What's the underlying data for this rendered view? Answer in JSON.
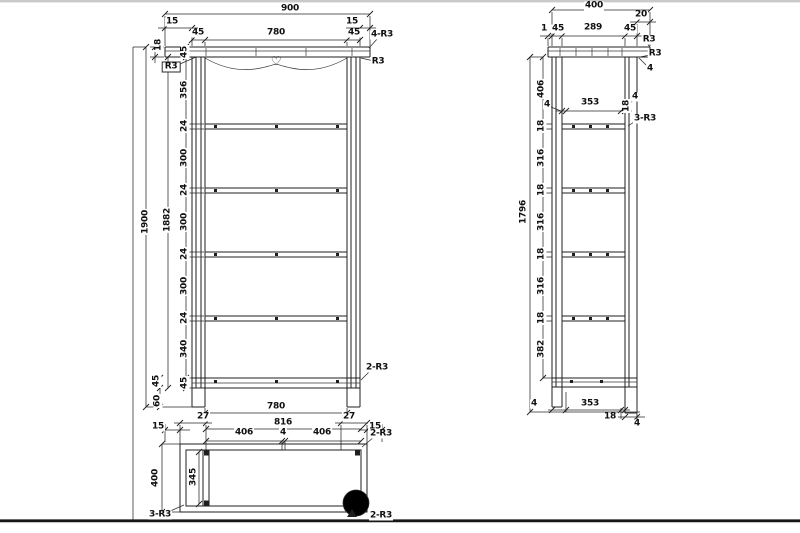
{
  "drawing": {
    "background": "#ffffff",
    "line_color": "#1f1f1f",
    "baseline_color": "#161616",
    "top_edge_color": "#c9c9c9",
    "heart_icon": "♡"
  },
  "views": {
    "front": {
      "labels": [
        {
          "name": "dim-overall-width",
          "text": "900",
          "x": 290,
          "y": 9
        },
        {
          "name": "dim-overhang-left",
          "text": "15",
          "x": 172,
          "y": 22
        },
        {
          "name": "dim-overhang-right",
          "text": "15",
          "x": 352,
          "y": 22
        },
        {
          "name": "dim-inner-width-top",
          "text": "780",
          "x": 276,
          "y": 33
        },
        {
          "name": "dim-post-width-top-left",
          "text": "45",
          "x": 198,
          "y": 33
        },
        {
          "name": "dim-post-width-top-right",
          "text": "45",
          "x": 354,
          "y": 33
        },
        {
          "name": "note-4-r3",
          "text": "4-R3",
          "x": 382,
          "y": 35
        },
        {
          "name": "dim-top-rail-thickness",
          "text": "18",
          "x": 159,
          "y": 45,
          "rot": 1
        },
        {
          "name": "dim-chain-45-top",
          "text": "45",
          "x": 185,
          "y": 52,
          "rot": 1
        },
        {
          "name": "note-r3-left",
          "text": "R3",
          "x": 171,
          "y": 67,
          "cls": "boxed"
        },
        {
          "name": "note-r3-right",
          "text": "R3",
          "x": 378,
          "y": 62
        },
        {
          "name": "dim-chain-356",
          "text": "356",
          "x": 185,
          "y": 90,
          "rot": 1
        },
        {
          "name": "dim-chain-24-1",
          "text": "24",
          "x": 185,
          "y": 126,
          "rot": 1
        },
        {
          "name": "dim-chain-300-1",
          "text": "300",
          "x": 185,
          "y": 158,
          "rot": 1
        },
        {
          "name": "dim-chain-24-2",
          "text": "24",
          "x": 185,
          "y": 190,
          "rot": 1
        },
        {
          "name": "dim-chain-300-2",
          "text": "300",
          "x": 185,
          "y": 222,
          "rot": 1
        },
        {
          "name": "dim-chain-24-3",
          "text": "24",
          "x": 185,
          "y": 254,
          "rot": 1
        },
        {
          "name": "dim-chain-300-3",
          "text": "300",
          "x": 185,
          "y": 286,
          "rot": 1
        },
        {
          "name": "dim-chain-24-4",
          "text": "24",
          "x": 185,
          "y": 318,
          "rot": 1
        },
        {
          "name": "dim-chain-340",
          "text": "340",
          "x": 185,
          "y": 349,
          "rot": 1
        },
        {
          "name": "dim-chain-45-bottom",
          "text": "45",
          "x": 185,
          "y": 383,
          "rot": 1
        },
        {
          "name": "dim-overall-height",
          "text": "1900",
          "x": 146,
          "y": 222,
          "rot": 1
        },
        {
          "name": "dim-inner-height",
          "text": "1882",
          "x": 168,
          "y": 220,
          "rot": 1
        },
        {
          "name": "dim-bottom-rail-45",
          "text": "45",
          "x": 157,
          "y": 381,
          "rot": 1
        },
        {
          "name": "dim-leg-height-60",
          "text": "60",
          "x": 158,
          "y": 401,
          "rot": 1
        },
        {
          "name": "dim-inner-width-bottom",
          "text": "780",
          "x": 276,
          "y": 407
        },
        {
          "name": "note-2-r3-front",
          "text": "2-R3",
          "x": 377,
          "y": 368
        },
        {
          "name": "heart-icon",
          "text": "♡",
          "x": 276,
          "y": 61,
          "cls": "heart"
        }
      ]
    },
    "plan": {
      "labels": [
        {
          "name": "dim-plan-15-left",
          "text": "15",
          "x": 158,
          "y": 427
        },
        {
          "name": "dim-plan-27-left",
          "text": "27",
          "x": 203,
          "y": 417
        },
        {
          "name": "dim-plan-27-right",
          "text": "27",
          "x": 349,
          "y": 417
        },
        {
          "name": "dim-plan-816",
          "text": "816",
          "x": 283,
          "y": 423
        },
        {
          "name": "dim-plan-4",
          "text": "4",
          "x": 283,
          "y": 433
        },
        {
          "name": "dim-plan-406-left",
          "text": "406",
          "x": 244,
          "y": 433
        },
        {
          "name": "dim-plan-406-right",
          "text": "406",
          "x": 322,
          "y": 433
        },
        {
          "name": "dim-plan-15-right",
          "text": "15",
          "x": 375,
          "y": 427
        },
        {
          "name": "note-2-r3-plan-top",
          "text": "2-R3",
          "x": 381,
          "y": 434
        },
        {
          "name": "dim-plan-400",
          "text": "400",
          "x": 156,
          "y": 478,
          "rot": 1
        },
        {
          "name": "dim-plan-345",
          "text": "345",
          "x": 194,
          "y": 477,
          "rot": 1
        },
        {
          "name": "note-3-r3-plan",
          "text": "3-R3",
          "x": 160,
          "y": 515
        },
        {
          "name": "note-2-r3-plan-bottom",
          "text": "2-R3",
          "x": 381,
          "y": 516
        }
      ]
    },
    "side": {
      "labels": [
        {
          "name": "dim-side-width",
          "text": "400",
          "x": 594,
          "y": 6
        },
        {
          "name": "dim-side-20",
          "text": "20",
          "x": 641,
          "y": 15
        },
        {
          "name": "dim-side-1",
          "text": "1",
          "x": 544,
          "y": 29
        },
        {
          "name": "dim-side-45-left",
          "text": "45",
          "x": 558,
          "y": 29
        },
        {
          "name": "dim-side-289",
          "text": "289",
          "x": 593,
          "y": 28
        },
        {
          "name": "dim-side-45-right",
          "text": "45",
          "x": 630,
          "y": 29
        },
        {
          "name": "note-r3-side-top",
          "text": "R3",
          "x": 649,
          "y": 40
        },
        {
          "name": "note-r3-side-mid",
          "text": "R3",
          "x": 655,
          "y": 54
        },
        {
          "name": "dim-side-4-top",
          "text": "4",
          "x": 650,
          "y": 69
        },
        {
          "name": "dim-side-406",
          "text": "406",
          "x": 542,
          "y": 89,
          "rot": 1
        },
        {
          "name": "dim-side-4-shelf-left",
          "text": "4",
          "x": 547,
          "y": 105
        },
        {
          "name": "dim-side-353-top",
          "text": "353",
          "x": 590,
          "y": 103
        },
        {
          "name": "dim-side-4-shelf-right",
          "text": "4",
          "x": 635,
          "y": 97
        },
        {
          "name": "dim-side-18-shelf",
          "text": "18",
          "x": 627,
          "y": 106,
          "rot": 1
        },
        {
          "name": "note-3-r3-side",
          "text": "3-R3",
          "x": 645,
          "y": 119
        },
        {
          "name": "dim-side-18-1",
          "text": "18",
          "x": 542,
          "y": 126,
          "rot": 1
        },
        {
          "name": "dim-side-316-1",
          "text": "316",
          "x": 542,
          "y": 158,
          "rot": 1
        },
        {
          "name": "dim-side-18-2",
          "text": "18",
          "x": 542,
          "y": 190,
          "rot": 1
        },
        {
          "name": "dim-side-316-2",
          "text": "316",
          "x": 542,
          "y": 222,
          "rot": 1
        },
        {
          "name": "dim-side-18-3",
          "text": "18",
          "x": 542,
          "y": 254,
          "rot": 1
        },
        {
          "name": "dim-side-316-3",
          "text": "316",
          "x": 542,
          "y": 286,
          "rot": 1
        },
        {
          "name": "dim-side-18-4",
          "text": "18",
          "x": 542,
          "y": 318,
          "rot": 1
        },
        {
          "name": "dim-side-382",
          "text": "382",
          "x": 542,
          "y": 349,
          "rot": 1
        },
        {
          "name": "dim-side-1796",
          "text": "1796",
          "x": 524,
          "y": 212,
          "rot": 1
        },
        {
          "name": "dim-side-4-bottom-left",
          "text": "4",
          "x": 534,
          "y": 404
        },
        {
          "name": "dim-side-353-bottom",
          "text": "353",
          "x": 590,
          "y": 404
        },
        {
          "name": "dim-side-18-bottom",
          "text": "18",
          "x": 610,
          "y": 417
        },
        {
          "name": "dim-side-4-bottom-right",
          "text": "4",
          "x": 637,
          "y": 424
        }
      ]
    }
  }
}
